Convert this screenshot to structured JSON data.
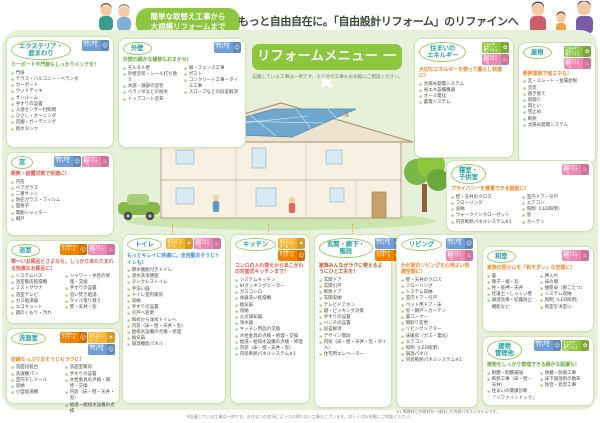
{
  "header": {
    "bubble": "簡単な取替え工事から\n大規模リフォームまで",
    "headline": "もっと自由自在に。「自由設計リフォーム」のリファインへご相談ください。"
  },
  "banner": {
    "title": "リフォームメニュー 一覧",
    "subtitle": "記載している工事は一例です。その他の工事もお気軽にご相談ください。"
  },
  "tags": {
    "madori": {
      "label": "間取り変更リフォーム",
      "color": "#6f9fd8",
      "icon": "people-icon",
      "glyph": "☺"
    },
    "ud": {
      "label": "お手軽U.D.リフォーム",
      "color": "#f08300",
      "icon": "person-icon",
      "glyph": "☺"
    },
    "soap": {
      "label": "おそうじラクラクリフォーム",
      "color": "#f7b52c",
      "icon": "sparkle-icon",
      "glyph": "✦"
    },
    "dannetsu": {
      "label": "気持ちよく断熱リフォーム",
      "color": "#ef87b5",
      "icon": "kettle-icon",
      "glyph": "♨"
    },
    "energy": {
      "label": "エネルギーをかしこく使うリフォーム",
      "color": "#8cc63f",
      "icon": "leaf-icon",
      "glyph": "✿"
    }
  },
  "boxes": [
    {
      "key": "exterior",
      "title": "エクステリア・\n庭まわり",
      "tagline": "カーポートや門扉もしっかりメンテを!",
      "tagline_color": "#6aaa3c",
      "badges": [
        "madori"
      ],
      "columns": [
        [
          "門扉",
          "テラス・バルコニー・ベランダ",
          "カーポート",
          "ウッドデッキ",
          "サンルーム",
          "手すりの設置",
          "人感センサー付照明",
          "ひさし・オーニング",
          "造園・ガーデニング",
          "雨水タンク"
        ]
      ]
    },
    {
      "key": "gaiheki",
      "title": "外壁",
      "tagline": "外壁の細かな補修もおまかせ!",
      "tagline_color": "#6aaa3c",
      "badges": [
        "madori"
      ],
      "columns": [
        [
          "モルタル壁",
          "外壁塗装・シール打ち替え",
          "木部・鉄部の塗装",
          "ベランダなどの防水",
          "トップコート塗布"
        ],
        [
          "塀・フェンス工事",
          "ポスト",
          "コンクリート工事・タイル工事",
          "スロープなどの段差解消"
        ]
      ]
    },
    {
      "key": "mado",
      "title": "窓",
      "tagline": "断熱・結露対策で快適に!",
      "tagline_color": "#e8554a",
      "badges": [
        "madori",
        "dannetsu"
      ],
      "columns": [
        [
          "内窓",
          "ペアガラス",
          "二重サッシ",
          "防犯ガラス・フィルム",
          "面格子",
          "電動シャッター",
          "網戸"
        ]
      ]
    },
    {
      "key": "energy",
      "title": "住まいの\nエネルギー",
      "tagline": "大切なエネルギーを使って暮らし快適に!",
      "tagline_color": "#f0831e",
      "badges": [
        "energy",
        "dannetsu"
      ],
      "columns": [
        [
          "太陽光発電システム",
          "省エネ設備機器",
          "オール電化",
          "蓄電システム"
        ]
      ]
    },
    {
      "key": "yane",
      "title": "屋根",
      "tagline": "断熱塗装で省エネも!",
      "tagline_color": "#f0831e",
      "badges": [
        "energy",
        "dannetsu"
      ],
      "columns": [
        [
          "瓦・スレート・金属屋根",
          "塗装",
          "葺き替え",
          "雨漏り",
          "雨とい",
          "雪止め",
          "断熱",
          "太陽光発電システム"
        ]
      ]
    },
    {
      "key": "shinshitsu",
      "title": "寝室・\n子供室",
      "tagline": "プライバシーを尊重できる個室に!",
      "tagline_color": "#f0831e",
      "badges": [
        "dannetsu"
      ],
      "columns": [
        [
          "壁・天井のクロス",
          "フローリング",
          "収納",
          "ウォークインクローゼット",
          "内装断熱パネルシステム※1"
        ],
        [
          "室内ドア・引戸",
          "エアコン",
          "照明（LED照明）",
          "窓",
          "カーテン"
        ]
      ]
    },
    {
      "key": "bath",
      "title": "浴室",
      "tagline": "寒〜いお風呂とさよなら。しっかりあたたまれる快適なお風呂に!",
      "tagline_color": "#e8554a",
      "badges": [
        "ud",
        "dannetsu"
      ],
      "columns": [
        [
          "システムバス",
          "浴室暖房乾燥機",
          "ミストサウナ",
          "浴室テレビ",
          "ガス給湯器",
          "エコキュート",
          "鏡のくもり・汚れ"
        ],
        [
          "シャワー・水栓の修理・交換",
          "手すりの設置",
          "追い焚き給湯",
          "タイル張り替え",
          "壁・天井・窓"
        ]
      ]
    },
    {
      "key": "senmen",
      "title": "洗面室",
      "tagline": "収納たっぷりおそうじもラクに!",
      "tagline_color": "#f0831e",
      "badges": [
        "ud",
        "soap",
        "madori"
      ],
      "columns": [
        [
          "洗面化粧台",
          "洗濯機パン",
          "室内干しツール",
          "収納",
          "小型給湯機"
        ],
        [
          "洗面室暖房",
          "手すりの設置",
          "水栓金具の点検・補修・交換",
          "内装（床・壁・天井・窓）",
          "給湯・給排水設備の点検"
        ]
      ]
    },
    {
      "key": "toilet",
      "title": "トイレ",
      "tagline": "もっとキレイに快適に。全自動おそうじトイレも!",
      "tagline_color": "#3f8fd2",
      "badges": [
        "soap",
        "dannetsu"
      ],
      "columns": [
        [
          "節水機能付きトイレ",
          "温水洗浄便座",
          "タンクレストイレ",
          "手洗い器",
          "トイレ室内暖房",
          "収納",
          "手すりの設置",
          "引戸へ変更",
          "和式から洋式トイレへ",
          "内装（床・壁・天井・窓）",
          "給排水設備の点検・修理",
          "換気扇",
          "調湿機能パネル"
        ]
      ]
    },
    {
      "key": "kitchen",
      "title": "キッチン",
      "tagline": "コンロの入れ替えからあこがれの対面式キッチンまで!",
      "tagline_color": "#e8554a",
      "badges": [
        "soap",
        "ud"
      ],
      "columns": [
        [
          "システムキッチン",
          "IHクッキングヒーター",
          "ガスコンロ",
          "食器洗い乾燥機",
          "換気扇",
          "収納",
          "火災報知器",
          "浄水器",
          "キッチン用品の交換",
          "水栓金具の点検・修理・交換",
          "給湯・給排水設備の点検・修理",
          "内装（床・壁・天井・窓）",
          "内装断熱パネルシステム※1"
        ]
      ]
    },
    {
      "key": "genkan",
      "title": "玄関・廊下・\n階段",
      "tagline": "家族みんながラクに使えるようにひと工夫を!",
      "tagline_color": "#b05a2a",
      "badges": [
        "madori",
        "ud"
      ],
      "columns": [
        [
          "玄関ドア",
          "玄関引戸",
          "断熱ドア",
          "玄関収納",
          "テレビドアホン",
          "鍵・ピッキング対策",
          "手すりの設置",
          "ベンチの設置",
          "段差解消",
          "デザイン階段",
          "内装（床・壁・天井・窓・タイル）",
          "住宅用エレベーター"
        ]
      ]
    },
    {
      "key": "living",
      "title": "リビング",
      "tagline": "わが家のリビングを心地よい快適空間に!",
      "tagline_color": "#f0831e",
      "badges": [
        "madori",
        "dannetsu"
      ],
      "columns": [
        [
          "壁・天井のクロス",
          "フローリング",
          "システム収納",
          "室内ドア・引戸",
          "ペット用ドア・床",
          "窓・網戸・カーテン",
          "畳コーナー",
          "間取り変更",
          "リビングシアター",
          "床暖房（ガス・電気）",
          "エアコン",
          "照明（LED照明）",
          "調湿パネル",
          "内装断熱パネルシステム※1"
        ]
      ]
    },
    {
      "key": "washitsu",
      "title": "和室",
      "tagline": "家族の団らんを「和モダン」な空間に!",
      "tagline_color": "#f0831e",
      "badges": [
        "dannetsu"
      ],
      "columns": [
        [
          "畳",
          "障子・襖・窓",
          "柱・長押・天井",
          "珪藻土・しっくい壁",
          "調湿効果・結露防止機能など"
        ],
        [
          "押入れ",
          "床の間",
          "掘座卓（掘ごたつ）",
          "システム収納",
          "照明（LED照明）",
          "和室を洋室に"
        ]
      ]
    },
    {
      "key": "tatemono",
      "title": "建物\n管理他",
      "tagline": "建物をしっかり管理できる細かな配慮も!",
      "tagline_color": "#6aaa3c",
      "badges": [
        "madori",
        "energy"
      ],
      "columns": [
        [
          "耐震・制震補強",
          "断熱工事（床・壁・天井）",
          "住まいの健康診断「リファインドック」"
        ],
        [
          "防蟻・防腐工事",
          "床下調湿剤の散布",
          "防音・遮音工事"
        ]
      ]
    }
  ],
  "footnotes": {
    "note1": "※1 断熱材と内装材を一体化した内装パネルシステムです。",
    "bottom": "※記載している工事は一例です。お住まいの状況によっては承れない工事もございます。詳しくはお気軽にご相談ください。"
  },
  "colors": {
    "panel": "#e7f1da",
    "brand_green": "#8dc63f",
    "title_teal": "#1fa3a0"
  }
}
